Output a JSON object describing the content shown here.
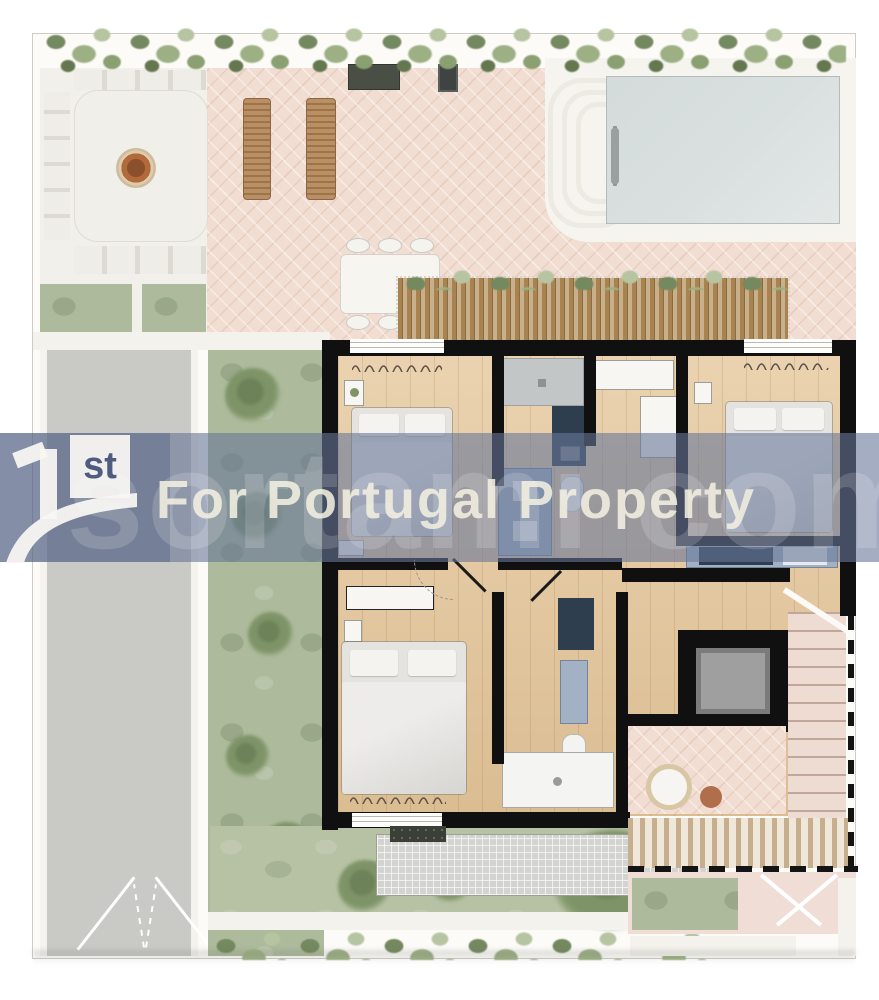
{
  "watermark": {
    "logo_numeral": "1",
    "logo_suffix": "st",
    "headline": "For Portugal Property",
    "background_text": "sortami com"
  },
  "palette": {
    "band": "rgba(104,118,152,0.60)",
    "band-deep": "rgba(58,74,110,0.30)",
    "wm-text": "rgba(243,239,224,0.88)",
    "wm-faint": "rgba(255,255,255,0.16)",
    "logo-ink": "#4e5d7f",
    "logo-white": "rgba(248,247,243,0.94)",
    "wall": "#101010",
    "wood": "#e6c99f",
    "terrace": "#f2ddd2",
    "patio": "#f2f0ea",
    "pool": "#d9e0df",
    "deck": "#f5f4ef",
    "lawn": "#b7c2a4",
    "garden": "#adbb9c",
    "hedge": "#7e9468",
    "driveway": "#c9c9c6",
    "pergola": "#a8834f",
    "pergola-light": "#c9b08c",
    "cabinet": "#a2b1c4",
    "appliance": "#2f3e4e",
    "elevator": "#9f9f9f",
    "stairs": "#eedcd2",
    "stair-line": "#c1a799",
    "grate": "#d3d4d0",
    "firepit": "#b06a3c",
    "path": "#f4f2ec"
  }
}
